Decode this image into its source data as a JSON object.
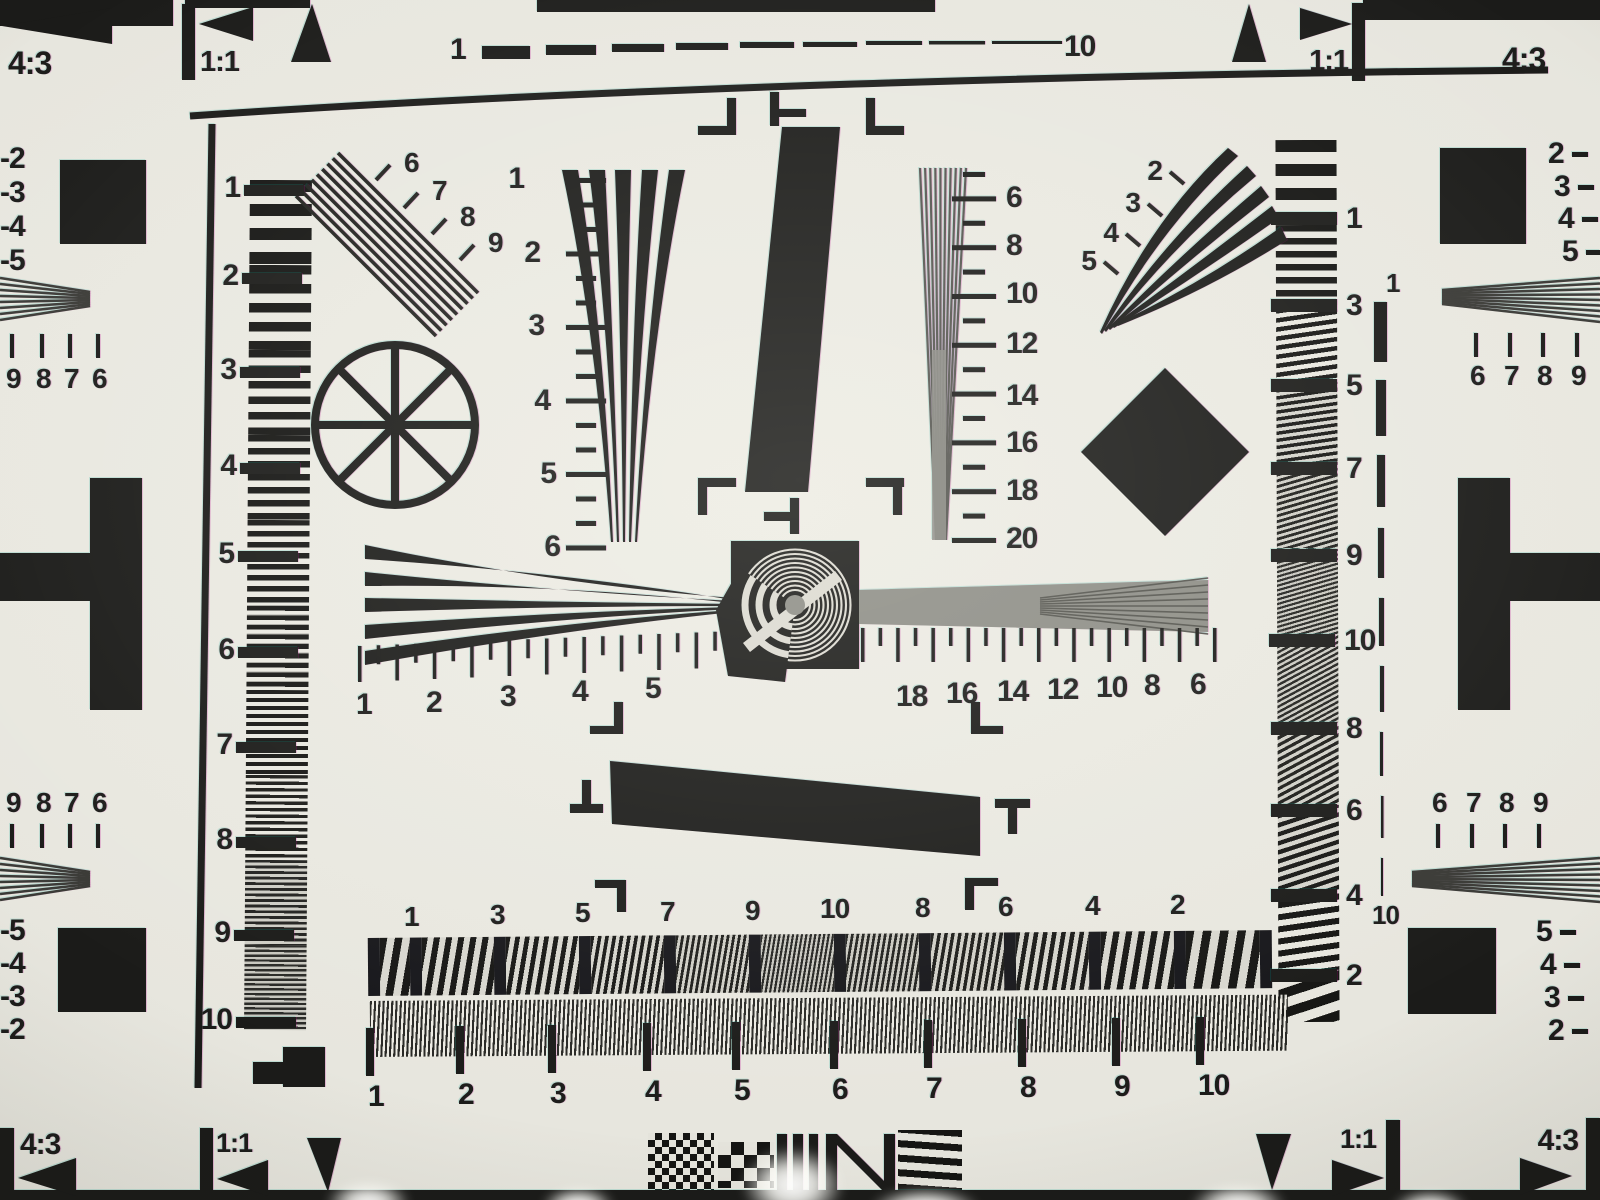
{
  "colors": {
    "ink": "#1b1b19",
    "paper": "#e8e7df",
    "grey": "#8d8d86"
  },
  "groups": {
    "corner_labels": {
      "size": 32,
      "items": [
        {
          "t": "4:3",
          "x": 8,
          "y": 74
        },
        {
          "t": "1:1",
          "x": 200,
          "y": 71,
          "s": 29
        },
        {
          "t": "1:1",
          "x": 1348,
          "y": 70,
          "s": 29,
          "a": "end"
        },
        {
          "t": "4:3",
          "x": 1502,
          "y": 70
        },
        {
          "t": "4:3",
          "x": 20,
          "y": 1154,
          "s": 30
        },
        {
          "t": "1:1",
          "x": 216,
          "y": 1152,
          "s": 27
        },
        {
          "t": "1:1",
          "x": 1376,
          "y": 1148,
          "s": 27,
          "a": "end"
        },
        {
          "t": "4:3",
          "x": 1578,
          "y": 1150,
          "s": 30,
          "a": "end"
        }
      ]
    },
    "top_ruler_labels": {
      "size": 30,
      "items": [
        {
          "t": "1",
          "x": 450,
          "y": 59
        },
        {
          "t": "10",
          "x": 1064,
          "y": 56
        }
      ]
    },
    "left_neg_top": {
      "size": 30,
      "items": [
        {
          "t": "-2",
          "x": 0,
          "y": 168
        },
        {
          "t": "-3",
          "x": 0,
          "y": 202
        },
        {
          "t": "-4",
          "x": 0,
          "y": 236
        },
        {
          "t": "-5",
          "x": 0,
          "y": 270
        }
      ]
    },
    "left_digits_top": {
      "size": 28,
      "items": [
        {
          "t": "9",
          "x": 6,
          "y": 388
        },
        {
          "t": "8",
          "x": 36,
          "y": 388
        },
        {
          "t": "7",
          "x": 64,
          "y": 388
        },
        {
          "t": "6",
          "x": 92,
          "y": 388
        }
      ]
    },
    "left_digits_bot": {
      "size": 28,
      "items": [
        {
          "t": "9",
          "x": 6,
          "y": 812
        },
        {
          "t": "8",
          "x": 36,
          "y": 812
        },
        {
          "t": "7",
          "x": 64,
          "y": 812
        },
        {
          "t": "6",
          "x": 92,
          "y": 812
        }
      ]
    },
    "left_neg_bot": {
      "size": 30,
      "items": [
        {
          "t": "-5",
          "x": 0,
          "y": 940
        },
        {
          "t": "-4",
          "x": 0,
          "y": 973
        },
        {
          "t": "-3",
          "x": 0,
          "y": 1006
        },
        {
          "t": "-2",
          "x": 0,
          "y": 1039
        }
      ]
    },
    "right_neg_top": {
      "size": 30,
      "items": [
        {
          "t": "2",
          "x": 1548,
          "y": 163
        },
        {
          "t": "3",
          "x": 1554,
          "y": 196
        },
        {
          "t": "4",
          "x": 1558,
          "y": 228
        },
        {
          "t": "5",
          "x": 1562,
          "y": 261
        }
      ]
    },
    "right_digits_top": {
      "size": 28,
      "items": [
        {
          "t": "6",
          "x": 1470,
          "y": 385
        },
        {
          "t": "7",
          "x": 1504,
          "y": 385
        },
        {
          "t": "8",
          "x": 1537,
          "y": 385
        },
        {
          "t": "9",
          "x": 1571,
          "y": 385
        }
      ]
    },
    "right_digits_bot": {
      "size": 28,
      "items": [
        {
          "t": "6",
          "x": 1432,
          "y": 812
        },
        {
          "t": "7",
          "x": 1466,
          "y": 812
        },
        {
          "t": "8",
          "x": 1499,
          "y": 812
        },
        {
          "t": "9",
          "x": 1533,
          "y": 812
        }
      ]
    },
    "right_neg_bot": {
      "size": 30,
      "items": [
        {
          "t": "5",
          "x": 1536,
          "y": 941
        },
        {
          "t": "4",
          "x": 1540,
          "y": 974
        },
        {
          "t": "3",
          "x": 1544,
          "y": 1007
        },
        {
          "t": "2",
          "x": 1548,
          "y": 1040
        }
      ]
    },
    "left_column_scale": {
      "size": 30,
      "anchor": "end",
      "items": [
        {
          "t": "1",
          "x": 240,
          "y": 197
        },
        {
          "t": "2",
          "x": 238,
          "y": 285
        },
        {
          "t": "3",
          "x": 236,
          "y": 379
        },
        {
          "t": "4",
          "x": 236,
          "y": 475
        },
        {
          "t": "5",
          "x": 234,
          "y": 563
        },
        {
          "t": "6",
          "x": 234,
          "y": 659
        },
        {
          "t": "7",
          "x": 232,
          "y": 754
        },
        {
          "t": "8",
          "x": 232,
          "y": 849
        },
        {
          "t": "9",
          "x": 230,
          "y": 942
        },
        {
          "t": "10",
          "x": 232,
          "y": 1029
        }
      ]
    },
    "right_column_scale": {
      "size": 30,
      "items": [
        {
          "t": "1",
          "x": 1346,
          "y": 228
        },
        {
          "t": "3",
          "x": 1346,
          "y": 315
        },
        {
          "t": "5",
          "x": 1346,
          "y": 395
        },
        {
          "t": "7",
          "x": 1346,
          "y": 478
        },
        {
          "t": "9",
          "x": 1346,
          "y": 565
        },
        {
          "t": "10",
          "x": 1344,
          "y": 650
        },
        {
          "t": "8",
          "x": 1346,
          "y": 738
        },
        {
          "t": "6",
          "x": 1346,
          "y": 820
        },
        {
          "t": "4",
          "x": 1346,
          "y": 905
        },
        {
          "t": "2",
          "x": 1346,
          "y": 985
        }
      ]
    },
    "left_wedge_scale": {
      "size": 30,
      "anchor": "end",
      "items": [
        {
          "t": "1",
          "x": 524,
          "y": 188
        },
        {
          "t": "2",
          "x": 540,
          "y": 262
        },
        {
          "t": "3",
          "x": 544,
          "y": 335
        },
        {
          "t": "4",
          "x": 550,
          "y": 410
        },
        {
          "t": "5",
          "x": 556,
          "y": 483
        },
        {
          "t": "6",
          "x": 560,
          "y": 556
        }
      ]
    },
    "right_wedge_scale": {
      "size": 30,
      "items": [
        {
          "t": "6",
          "x": 1006,
          "y": 207
        },
        {
          "t": "8",
          "x": 1006,
          "y": 255
        },
        {
          "t": "10",
          "x": 1006,
          "y": 303
        },
        {
          "t": "12",
          "x": 1006,
          "y": 353
        },
        {
          "t": "14",
          "x": 1006,
          "y": 405
        },
        {
          "t": "16",
          "x": 1006,
          "y": 452
        },
        {
          "t": "18",
          "x": 1006,
          "y": 500
        },
        {
          "t": "20",
          "x": 1006,
          "y": 548
        }
      ]
    },
    "diag_wedge_scale": {
      "size": 28,
      "items": [
        {
          "t": "6",
          "x": 404,
          "y": 172
        },
        {
          "t": "7",
          "x": 432,
          "y": 200
        },
        {
          "t": "8",
          "x": 460,
          "y": 226
        },
        {
          "t": "9",
          "x": 488,
          "y": 252
        }
      ]
    },
    "fan_wedge_scale": {
      "size": 28,
      "anchor": "end",
      "items": [
        {
          "t": "2",
          "x": 1162,
          "y": 180
        },
        {
          "t": "3",
          "x": 1140,
          "y": 212
        },
        {
          "t": "4",
          "x": 1118,
          "y": 242
        },
        {
          "t": "5",
          "x": 1096,
          "y": 270
        }
      ]
    },
    "center_ruler_left": {
      "size": 30,
      "items": [
        {
          "t": "1",
          "x": 356,
          "y": 714
        },
        {
          "t": "2",
          "x": 426,
          "y": 712
        },
        {
          "t": "3",
          "x": 500,
          "y": 706
        },
        {
          "t": "4",
          "x": 572,
          "y": 701
        },
        {
          "t": "5",
          "x": 645,
          "y": 698
        }
      ]
    },
    "center_ruler_right": {
      "size": 30,
      "items": [
        {
          "t": "18",
          "x": 896,
          "y": 706
        },
        {
          "t": "16",
          "x": 946,
          "y": 703
        },
        {
          "t": "14",
          "x": 997,
          "y": 701
        },
        {
          "t": "12",
          "x": 1047,
          "y": 699
        },
        {
          "t": "10",
          "x": 1096,
          "y": 697
        },
        {
          "t": "8",
          "x": 1144,
          "y": 695
        },
        {
          "t": "6",
          "x": 1190,
          "y": 694
        }
      ]
    },
    "bottom_rowA_scale": {
      "size": 28,
      "items": [
        {
          "t": "1",
          "x": 404,
          "y": 926
        },
        {
          "t": "3",
          "x": 490,
          "y": 924
        },
        {
          "t": "5",
          "x": 575,
          "y": 922
        },
        {
          "t": "7",
          "x": 660,
          "y": 921
        },
        {
          "t": "9",
          "x": 745,
          "y": 920
        },
        {
          "t": "10",
          "x": 820,
          "y": 918
        },
        {
          "t": "8",
          "x": 915,
          "y": 917
        },
        {
          "t": "6",
          "x": 998,
          "y": 916
        },
        {
          "t": "4",
          "x": 1085,
          "y": 915
        },
        {
          "t": "2",
          "x": 1170,
          "y": 914
        }
      ]
    },
    "bottom_rowB_scale": {
      "size": 30,
      "items": [
        {
          "t": "1",
          "x": 368,
          "y": 1106
        },
        {
          "t": "2",
          "x": 458,
          "y": 1104
        },
        {
          "t": "3",
          "x": 550,
          "y": 1103
        },
        {
          "t": "4",
          "x": 645,
          "y": 1101
        },
        {
          "t": "5",
          "x": 734,
          "y": 1100
        },
        {
          "t": "6",
          "x": 832,
          "y": 1099
        },
        {
          "t": "7",
          "x": 926,
          "y": 1098
        },
        {
          "t": "8",
          "x": 1020,
          "y": 1097
        },
        {
          "t": "9",
          "x": 1114,
          "y": 1096
        },
        {
          "t": "10",
          "x": 1198,
          "y": 1095
        }
      ]
    },
    "right_dashed_scale": {
      "size": 26,
      "items": [
        {
          "t": "1",
          "x": 1386,
          "y": 292
        },
        {
          "t": "10",
          "x": 1372,
          "y": 924
        }
      ]
    }
  }
}
